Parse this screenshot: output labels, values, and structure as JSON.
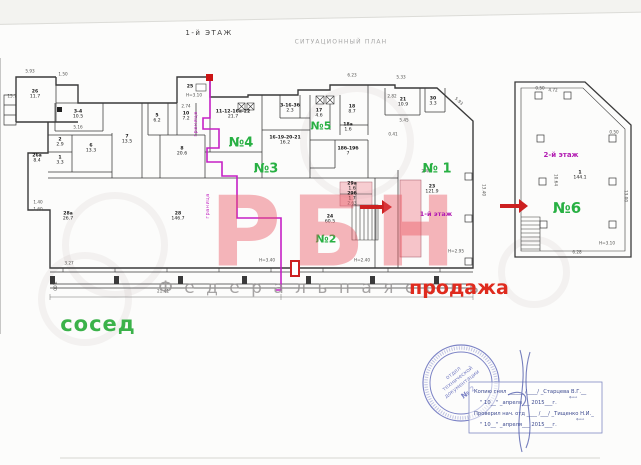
{
  "header": {
    "floor_title": "1-й ЭТАЖ",
    "situational_plan": "СИТУАЦИОННЫЙ ПЛАН"
  },
  "watermark": {
    "brand": "РБН",
    "network": "Ф е д е р а л ь н а я   с е т ь",
    "brand_color": "#e9525d"
  },
  "annotations": {
    "sale": "продажа",
    "neighbor": "сосед",
    "floor1": "1-й этаж",
    "floor2": "2-й этаж",
    "boundary": "граница",
    "sale_color": "#df2b1e",
    "green_color": "#28b043",
    "magenta_color": "#b21cb2"
  },
  "unit_labels": [
    {
      "t": "№4",
      "x": 241,
      "y": 143,
      "s": 13
    },
    {
      "t": "№3",
      "x": 266,
      "y": 169,
      "s": 13
    },
    {
      "t": "№5",
      "x": 321,
      "y": 126,
      "s": 11
    },
    {
      "t": "№2",
      "x": 326,
      "y": 239,
      "s": 11
    },
    {
      "t": "№ 1",
      "x": 437,
      "y": 169,
      "s": 13
    },
    {
      "t": "№6",
      "x": 567,
      "y": 208,
      "s": 15
    }
  ],
  "plan": {
    "rooms": [
      {
        "id": "26",
        "area": "11.7",
        "x": 35,
        "y": 95
      },
      {
        "id": "3-4",
        "area": "10.5",
        "x": 78,
        "y": 115
      },
      {
        "id": "5",
        "area": "6.2",
        "x": 157,
        "y": 119
      },
      {
        "id": "10",
        "area": "7.2",
        "x": 186,
        "y": 117
      },
      {
        "id": "2",
        "area": "2.9",
        "x": 60,
        "y": 143
      },
      {
        "id": "1",
        "area": "3.3",
        "x": 60,
        "y": 161
      },
      {
        "id": "6",
        "area": "13.3",
        "x": 91,
        "y": 149
      },
      {
        "id": "7",
        "area": "13.5",
        "x": 127,
        "y": 140
      },
      {
        "id": "8",
        "area": "20.6",
        "x": 182,
        "y": 152
      },
      {
        "id": "26а",
        "area": "8.4",
        "x": 37,
        "y": 159
      },
      {
        "id": "28а",
        "area": "26.7",
        "x": 68,
        "y": 217
      },
      {
        "id": "25",
        "area": "",
        "x": 190,
        "y": 87
      },
      {
        "id": "28",
        "area": "146.7",
        "x": 178,
        "y": 217
      },
      {
        "id": "24",
        "area": "60.5",
        "x": 330,
        "y": 220
      },
      {
        "id": "11-12-16а-22",
        "area": "21.7",
        "x": 233,
        "y": 115
      },
      {
        "id": "16-19-20-21",
        "area": "16.2",
        "x": 285,
        "y": 141
      },
      {
        "id": "3-16-3б",
        "area": "2.3",
        "x": 290,
        "y": 109
      },
      {
        "id": "17",
        "area": "4.6",
        "x": 319,
        "y": 114
      },
      {
        "id": "18",
        "area": "8.7",
        "x": 352,
        "y": 110
      },
      {
        "id": "18а",
        "area": "1.6",
        "x": 348,
        "y": 128
      },
      {
        "id": "18б-19б",
        "area": "7",
        "x": 348,
        "y": 152
      },
      {
        "id": "21",
        "area": "10.9",
        "x": 403,
        "y": 103
      },
      {
        "id": "30",
        "area": "3.3",
        "x": 433,
        "y": 102
      },
      {
        "id": "23",
        "area": "121.9",
        "x": 432,
        "y": 190
      },
      {
        "id": "29а",
        "area": "1.6",
        "x": 352,
        "y": 187
      },
      {
        "id": "29б",
        "area": "1.7",
        "x": 352,
        "y": 197
      },
      {
        "id": "1",
        "area": "144.1",
        "x": 580,
        "y": 176
      }
    ],
    "dimensions": [
      {
        "t": "5.93",
        "x": 30,
        "y": 71
      },
      {
        "t": "1.50",
        "x": 63,
        "y": 74
      },
      {
        "t": "15.7",
        "x": 12,
        "y": 96
      },
      {
        "t": "Н=3.10",
        "x": 194,
        "y": 95
      },
      {
        "t": "6.23",
        "x": 352,
        "y": 75
      },
      {
        "t": "5.33",
        "x": 401,
        "y": 77
      },
      {
        "t": "2.82",
        "x": 392,
        "y": 96
      },
      {
        "t": "2.74",
        "x": 186,
        "y": 106
      },
      {
        "t": "5.45",
        "x": 404,
        "y": 120
      },
      {
        "t": "0.41",
        "x": 393,
        "y": 134
      },
      {
        "t": "5.93",
        "x": 459,
        "y": 101,
        "r": 42
      },
      {
        "t": "13.40",
        "x": 484,
        "y": 190,
        "r": 90
      },
      {
        "t": "2.40",
        "x": 426,
        "y": 171
      },
      {
        "t": "Н=3.40",
        "x": 267,
        "y": 260
      },
      {
        "t": "Н=2.40",
        "x": 362,
        "y": 260
      },
      {
        "t": "Н=2.95",
        "x": 456,
        "y": 251
      },
      {
        "t": "21.41",
        "x": 163,
        "y": 291
      },
      {
        "t": "3.00",
        "x": 55,
        "y": 286,
        "r": 90
      },
      {
        "t": "1.40",
        "x": 38,
        "y": 202
      },
      {
        "t": "1.60",
        "x": 38,
        "y": 209
      },
      {
        "t": "3.27",
        "x": 69,
        "y": 263
      },
      {
        "t": "5.16",
        "x": 78,
        "y": 127
      },
      {
        "t": "2.63",
        "x": 352,
        "y": 203
      },
      {
        "t": "4.72",
        "x": 553,
        "y": 90
      },
      {
        "t": "0.50",
        "x": 540,
        "y": 88
      },
      {
        "t": "0.50",
        "x": 614,
        "y": 132
      },
      {
        "t": "13.00",
        "x": 626,
        "y": 196,
        "r": 90
      },
      {
        "t": "10.64",
        "x": 556,
        "y": 180,
        "r": 90
      },
      {
        "t": "6.28",
        "x": 577,
        "y": 252
      },
      {
        "t": "Н=3.10",
        "x": 607,
        "y": 243
      }
    ]
  },
  "stamp": {
    "dept_line1": "отдел",
    "dept_line2": "технической",
    "dept_line3": "документации",
    "number": "№ 2",
    "box_line1": "Копию снял ______ /____/ _Старцева В.Г.__",
    "box_line2": "\" 10__\" _апреля___ 2015___г.",
    "box_line3": "Проверил нач. отд ____ /___/ _Тищенко Н.И._",
    "box_line4": "\" 10__\" _апреля___ 2015___г.",
    "fio": "ф.и.о",
    "color": "#5b64b8"
  }
}
